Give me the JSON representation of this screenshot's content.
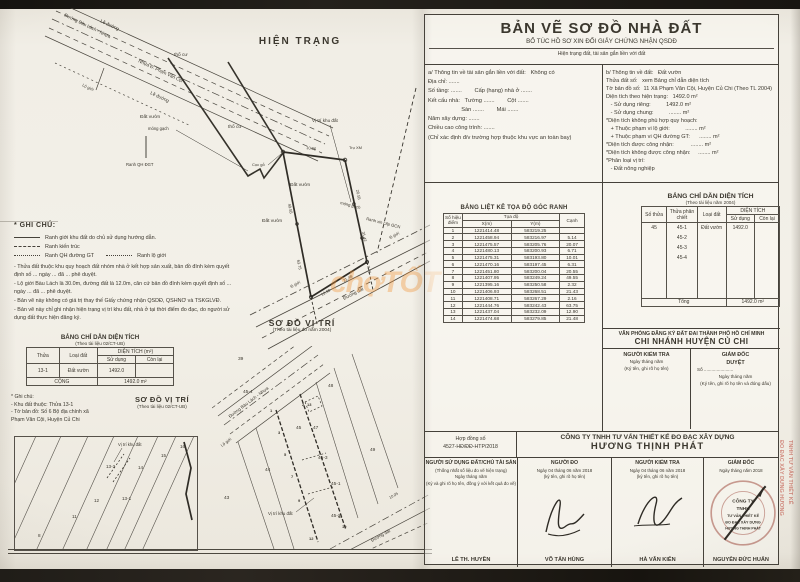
{
  "header": {
    "title": "BẢN VẼ SƠ ĐỒ NHÀ ĐẤT",
    "subtitle": "BỔ TÚC HỒ SƠ XIN ĐỔI GIẤY CHỨNG NHẬN QSDĐ",
    "note": "Hiện trạng đất, tài sản gắn liền với đất"
  },
  "info": {
    "left": [
      "a/ Thông tin về tài sản gắn liền với đất:   Không có",
      "Địa chỉ: .......",
      "Số tầng: .......        Cấp (hạng) nhà ở .......",
      "Kết cấu nhà:   Tường .......        Cột .......",
      "                     Sàn .......        Mái .......",
      "Năm xây dựng: .......",
      "Chiều cao công trình: .......",
      "(Chỉ xác định đ/v trường hợp thuộc khu vực an toàn bay)"
    ],
    "right": [
      "b/ Thông tin về đất:   Đất vườn",
      "Thửa đất số:   xem Bảng chỉ dẫn diện tích",
      "Tờ bản đồ số:  11 Xã Phạm Văn Cội, Huyện Củ Chi (Theo TL 2004)",
      "Diện tích theo hiện trạng:   1492.0 m²",
      "   - Sử dụng riêng:          1492.0 m²",
      "   - Sử dụng chung:          ........ m²",
      "*Diện tích không phù hợp quy hoạch:",
      "   + Thuộc phạm vi lộ giới:          ........ m²",
      "   + Thuộc phạm vi QH đường GT:      ........ m²",
      "*Diện tích được công nhận:           ........ m²",
      "*Diện tích không được công nhận:     ........ m²",
      "*Phân loại vị trí:",
      "   - Đất nông nghiệp"
    ]
  },
  "coord_table": {
    "title": "BẢNG LIỆT KÊ TỌA ĐỘ GÓC RANH",
    "col_point": "Số hiệu điểm",
    "col_coord": "Tọa độ",
    "col_x": "X(m)",
    "col_y": "Y(m)",
    "col_edge": "Cạnh",
    "rows": [
      {
        "n": "1",
        "x": "1221414.48",
        "y": "583219.25",
        "c": ""
      },
      {
        "n": "2",
        "x": "1221458.94",
        "y": "583216.97",
        "c": "5.14"
      },
      {
        "n": "3",
        "x": "1221475.57",
        "y": "583205.76",
        "c": "20.07"
      },
      {
        "n": "4",
        "x": "1221480.13",
        "y": "583200.93",
        "c": "6.71"
      },
      {
        "n": "5",
        "x": "1221475.31",
        "y": "583193.80",
        "c": "10.01"
      },
      {
        "n": "6",
        "x": "1221470.16",
        "y": "583197.45",
        "c": "6.31"
      },
      {
        "n": "7",
        "x": "1221451.80",
        "y": "583200.04",
        "c": "20.55"
      },
      {
        "n": "8",
        "x": "1221407.95",
        "y": "583249.24",
        "c": "49.55"
      },
      {
        "n": "9",
        "x": "1221395.16",
        "y": "583250.58",
        "c": "2.32"
      },
      {
        "n": "10",
        "x": "1221406.93",
        "y": "583268.51",
        "c": "21.43"
      },
      {
        "n": "11",
        "x": "1221408.71",
        "y": "583267.29",
        "c": "2.16"
      },
      {
        "n": "12",
        "x": "1221444.76",
        "y": "583242.43",
        "c": "63.75"
      },
      {
        "n": "13",
        "x": "1221437.04",
        "y": "583232.09",
        "c": "12.90"
      },
      {
        "n": "14",
        "x": "1221474.68",
        "y": "583279.85",
        "c": "21.48"
      }
    ]
  },
  "area_table": {
    "title": "BẢNG CHỈ DẪN DIỆN TÍCH",
    "source": "(Theo tài liệu năm 2004)",
    "col_so_thua": "Số thửa",
    "col_phan_chiet": "Thửa phân chiết",
    "col_loai_dat": "Loại đất",
    "col_dien_tich": "DIỆN TÍCH",
    "col_su_dung": "Sử dụng",
    "col_con_lai": "Còn lại",
    "so_thua": "45",
    "phan_chiet": [
      "45-1",
      "45-2",
      "45-3",
      "45-4"
    ],
    "loai_dat": "Đất vườn",
    "su_dung": "1492.0",
    "con_lai": "",
    "tong_label": "Tổng",
    "tong_value": "1492.0 m²"
  },
  "office": {
    "line1": "VĂN PHÒNG ĐĂNG KÝ ĐẤT ĐAI THÀNH PHỐ HỒ CHÍ MINH",
    "line2": "CHI NHÁNH HUYỆN CỦ CHI",
    "checker_title": "NGƯỜI KIỂM TRA",
    "checker_date": "Ngày      tháng      năm",
    "checker_note": "(Ký tên, ghi rõ họ tên)",
    "director_title": "GIÁM ĐỐC",
    "director_sub": "DUYỆT",
    "director_so": "Số .......................",
    "director_date": "Ngày      tháng      năm",
    "director_note": "(Ký tên, ghi rõ họ tên và đóng dấu)"
  },
  "company": {
    "contract_label": "Hợp đồng số",
    "contract_no": "4527-HĐ/ĐĐ-HTP/2018",
    "name": "CÔNG TY TNHH TƯ VẤN THIẾT KẾ ĐO ĐẠC XÂY DỰNG",
    "brand": "HƯƠNG THỊNH PHÁT"
  },
  "signatures": {
    "c1": {
      "title": "NGƯỜI SỬ DỤNG ĐẤT/CHỦ TÀI SẢN",
      "sub": "(Thống nhất số liệu đo vẽ hiện trạng)",
      "date": "Ngày      tháng      năm",
      "note": "(Ký và ghi rõ họ tên, đồng ý với kết quả đo vẽ)",
      "name": "LÊ TH. HUYỀN"
    },
    "c2": {
      "title": "NGƯỜI ĐO",
      "date": "Ngày 04  tháng 06  năm 2018",
      "note": "(ký tên, ghi rõ họ tên)",
      "name": "VÕ TẤN HÙNG"
    },
    "c3": {
      "title": "NGƯỜI KIỂM TRA",
      "date": "Ngày 04  tháng 06  năm 2018",
      "note": "(ký tên, ghi rõ họ tên)",
      "name": "HÀ VĂN KIÊN"
    },
    "c4": {
      "title": "GIÁM ĐỐC",
      "date": "Ngày      tháng      năm 2018",
      "note": "(ký tên, ghi rõ họ tên và đóng dấu)",
      "name": "NGUYỄN ĐỨC HUẤN",
      "stamp_lines": [
        "CÔNG TY",
        "TNHH",
        "TƯ VẤN THIẾT KẾ",
        "ĐO ĐẠC XÂY DỰNG",
        "HƯƠNG THỊNH PHÁT"
      ]
    },
    "bleed": [
      "TNHH TƯ VẤN THIẾT KẾ",
      "ĐO ĐẠC XÂY DỰNG  HƯƠNG"
    ]
  },
  "hien_trang": {
    "title": "HIỆN TRẠNG",
    "road_labels": [
      "Lề đường",
      "Đường Bàu Lách - Nhựa",
      "Nhựa Đ. Phạm Văn Cội",
      "Lề đường",
      "Lộ giới"
    ],
    "labels": [
      "thổ cư",
      "thổ cư",
      "Đất vườn",
      "Đất vườn",
      "Đất vườn",
      "móng gạch",
      "móng gạch",
      "Vị trí khu đất",
      "Trụ XM",
      "Cọc gỗ",
      "Ranh xin cấp GCN",
      "Ranh QH ĐGT",
      "Đường đất",
      "lộ giới",
      "lộ giới"
    ],
    "dims": [
      "10.05",
      "20.55",
      "31.42",
      "7.46",
      "49.55",
      "63.75",
      "12.90",
      "21.48"
    ]
  },
  "ghi_chu": {
    "title": "* GHI CHÚ:",
    "legend": [
      "Ranh giới khu đất do chủ sử dụng hướng dẫn.",
      "Ranh kiến trúc",
      "Ranh QH đường GT",
      "Ranh lộ giới"
    ],
    "notes": [
      "- Thửa đất thuộc khu quy hoạch đất nhóm nhà ở kết hợp sản xuất, bản đồ đính kèm quyết định số ... ngày ... đã ... phê duyệt.",
      "- Lộ giới Bàu Lách là 30.0m, đường đất là 12.0m, căn cứ bản đồ đính kèm quyết định số ... ngày ... đã ... phê duyệt.",
      "- Bản vẽ này không có giá trị thay thế Giấy chứng nhận QSDĐ, QSHNƠ và TSKGLVĐ.",
      "- Bản vẽ này chỉ ghi nhận hiện trạng vị trí khu đất, nhà ở tại thời điểm đo đạc, do người sử dụng đất thực hiện đăng ký."
    ]
  },
  "left_table": {
    "title": "BẢNG CHỈ DẪN DIỆN TÍCH",
    "source": "(Theo tài liệu 02/CT-UB)",
    "col_thua": "Thửa",
    "col_loai_dat": "Loại đất",
    "col_dien_tich": "DIỆN TÍCH (m²)",
    "col_su_dung": "Sử dụng",
    "col_con_lai": "Còn lại",
    "thua": "13-1",
    "loai_dat": "Đất vườn",
    "su_dung": "1492.0",
    "cong_label": "CỘNG",
    "cong_value": "1492.0 m²"
  },
  "left_note": {
    "lines": [
      "* Ghi chú:",
      "- Khu đất thuộc: Thửa 13-1",
      "- Tờ bản đồ: Số 6 Bộ địa chính xã",
      "Phạm Văn Cội, Huyện Củ Chi"
    ]
  },
  "so_do_ctub": {
    "title": "SƠ ĐỒ VỊ TRÍ",
    "source": "(Theo tài liệu 02/CT-UB)",
    "vi_tri": "Vị trí khu đất",
    "parcels": [
      "8",
      "11",
      "12",
      "13-1",
      "13-2",
      "14",
      "15",
      "16"
    ]
  },
  "so_do_2004": {
    "title": "SƠ ĐỒ VỊ TRÍ",
    "source": "(Theo tài liệu đo năm 2004)",
    "road": "Đường Bàu Lách - Nhựa",
    "lo_gioi": "Lộ giới",
    "duong_dat": "Đường đất",
    "dim": "10.05",
    "vi_tri": "Vị trí khu đất",
    "parcels": [
      "39",
      "43",
      "44",
      "45",
      "47",
      "48",
      "49",
      "45-1",
      "45-2",
      "45-3",
      "45-4"
    ],
    "points": [
      "1",
      "2",
      "3",
      "5",
      "7",
      "9",
      "10",
      "11",
      "12",
      "13"
    ]
  },
  "watermark": "chợTỐT"
}
